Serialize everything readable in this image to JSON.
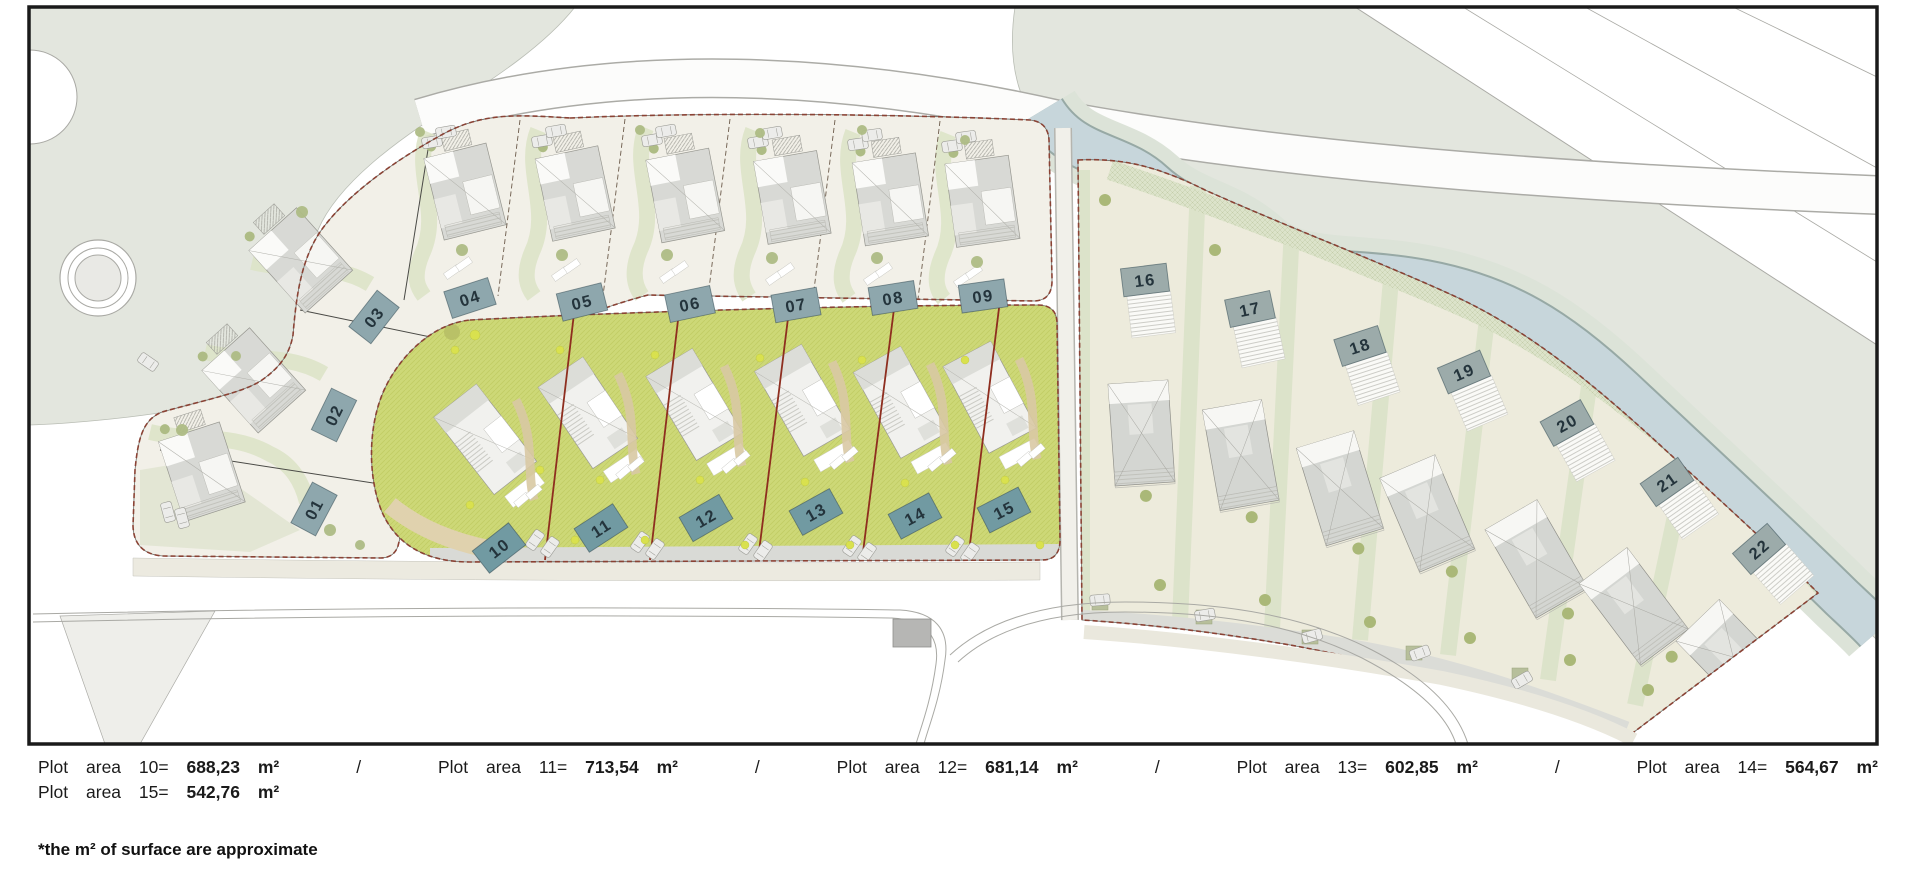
{
  "plan": {
    "plots": [
      {
        "number": "01"
      },
      {
        "number": "02"
      },
      {
        "number": "03"
      },
      {
        "number": "04"
      },
      {
        "number": "05"
      },
      {
        "number": "06"
      },
      {
        "number": "07"
      },
      {
        "number": "08"
      },
      {
        "number": "09"
      },
      {
        "number": "10"
      },
      {
        "number": "11"
      },
      {
        "number": "12"
      },
      {
        "number": "13"
      },
      {
        "number": "14"
      },
      {
        "number": "15"
      },
      {
        "number": "16"
      },
      {
        "number": "17"
      },
      {
        "number": "18"
      },
      {
        "number": "19"
      },
      {
        "number": "20"
      },
      {
        "number": "21"
      },
      {
        "number": "22"
      }
    ],
    "colors": {
      "landscape_sage": "#e3e6de",
      "river_water": "#c7d6db",
      "parcel_pale": "#f2f0e8",
      "lawn_green": "#cdd877",
      "fan_parcel": "#edebdc",
      "label_left_fill": "#8ea7ad",
      "label_mid_fill": "#719aa2",
      "label_fan_fill": "#9cabaa",
      "boundary_dashed": "#8a4234",
      "divider_red": "#8e2e1f",
      "frame": "#1a1a1a"
    }
  },
  "legend": {
    "separator": "/",
    "line1_items": [
      {
        "plot": "10",
        "label": "Plot area 10=",
        "value": "688,23",
        "unit": "m²"
      },
      {
        "plot": "11",
        "label": "Plot area 11=",
        "value": "713,54",
        "unit": "m²"
      },
      {
        "plot": "12",
        "label": "Plot area 12=",
        "value": "681,14",
        "unit": "m²"
      },
      {
        "plot": "13",
        "label": "Plot area 13=",
        "value": "602,85",
        "unit": "m²"
      },
      {
        "plot": "14",
        "label": "Plot area 14=",
        "value": "564,67",
        "unit": "m²"
      }
    ],
    "line2_items": [
      {
        "plot": "15",
        "label": "Plot area 15=",
        "value": "542,76",
        "unit": "m²"
      }
    ],
    "footnote": "*the m² of surface are approximate"
  }
}
